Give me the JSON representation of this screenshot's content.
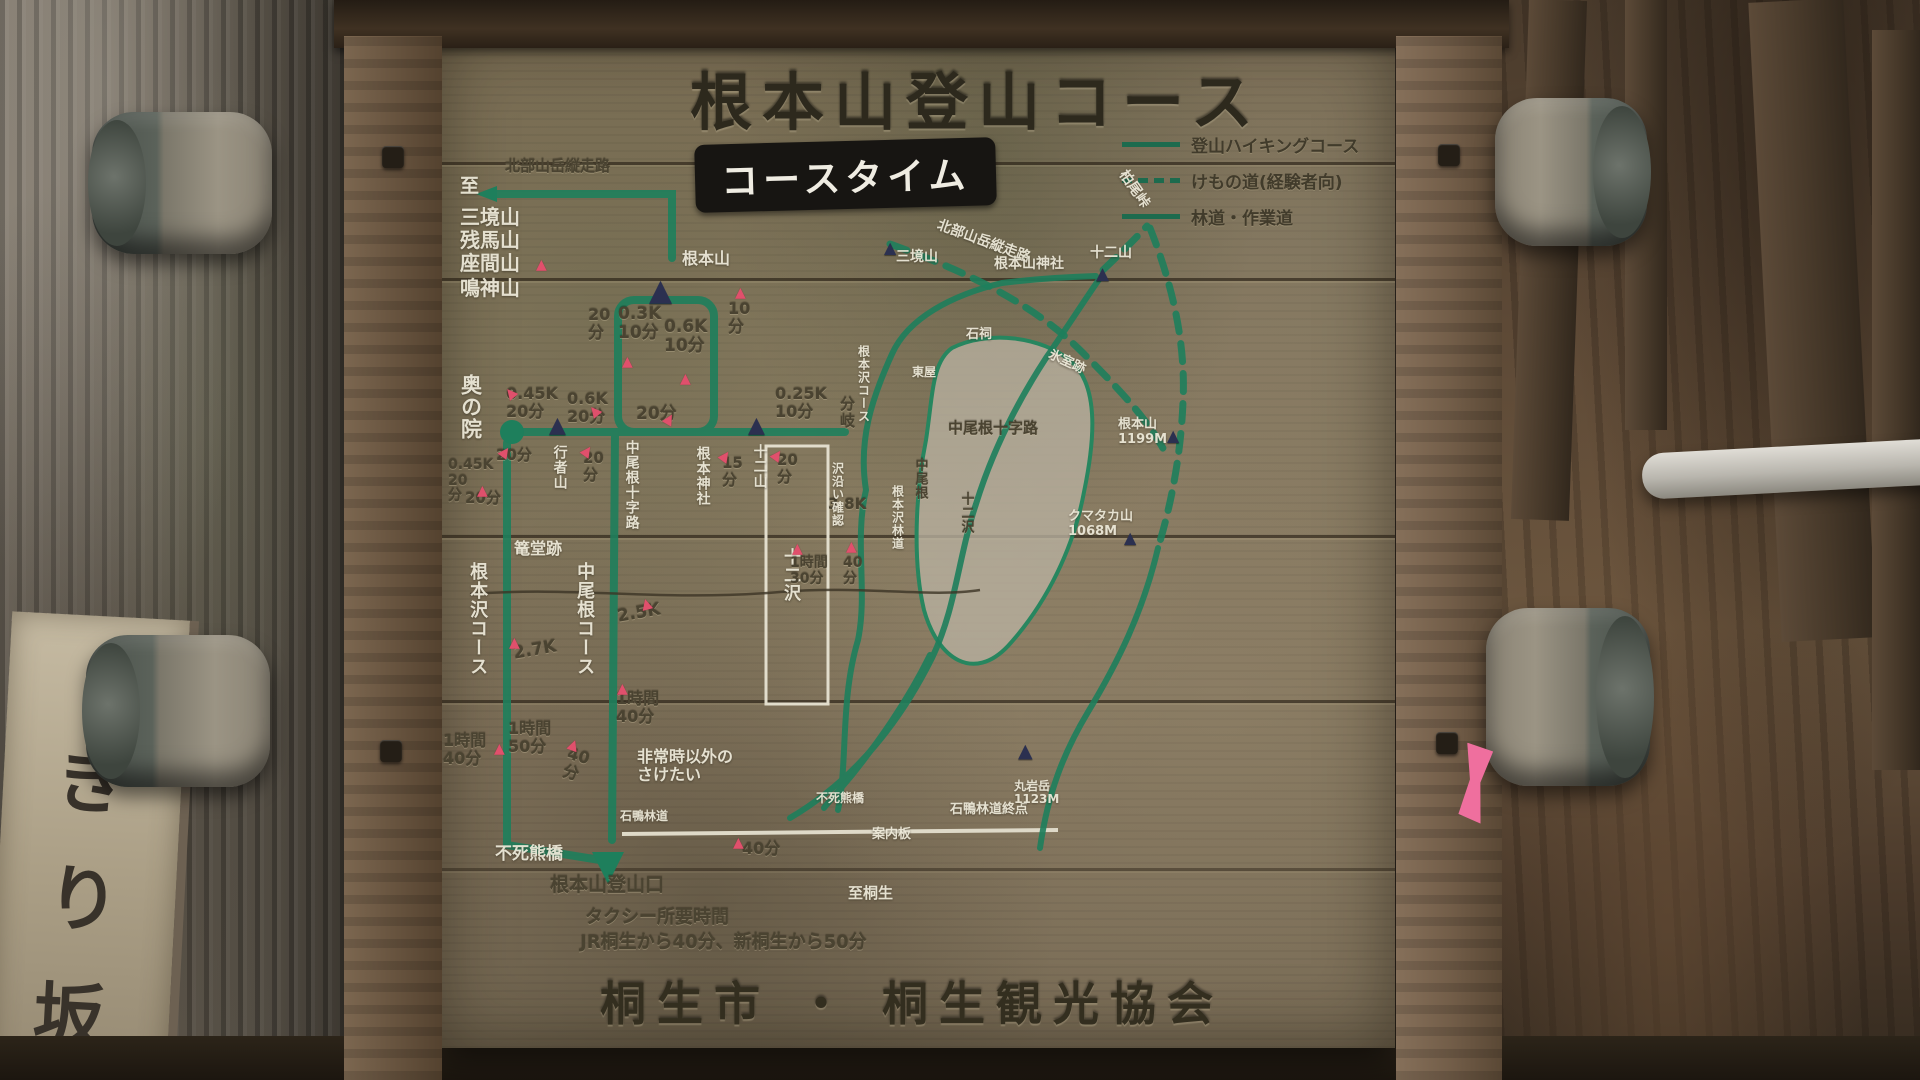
{
  "sign": {
    "title": "根本山登山コース",
    "course_time_heading": "コースタイム",
    "credit": "桐生市 ・ 桐生観光協会",
    "legend": {
      "items": [
        {
          "line": "solid",
          "label": "登山ハイキングコース"
        },
        {
          "line": "dashed",
          "label": "けもの道(経験者向)"
        },
        {
          "line": "solid",
          "label": "林道・作業道"
        }
      ]
    }
  },
  "course_chart": {
    "labels": [
      {
        "t": "至",
        "x": 460,
        "y": 176,
        "fs": 19,
        "c": "w"
      },
      {
        "t": "三境山",
        "x": 460,
        "y": 206,
        "fs": 20,
        "c": "w"
      },
      {
        "t": "残馬山",
        "x": 460,
        "y": 229,
        "fs": 20,
        "c": "w"
      },
      {
        "t": "座間山",
        "x": 460,
        "y": 252,
        "fs": 20,
        "c": "w"
      },
      {
        "t": "鳴神山",
        "x": 460,
        "y": 277,
        "fs": 20,
        "c": "w"
      },
      {
        "t": "北部山岳縦走路",
        "x": 505,
        "y": 158,
        "fs": 15,
        "c": "d"
      },
      {
        "t": "根本山",
        "x": 682,
        "y": 250,
        "fs": 16,
        "c": "w"
      },
      {
        "t": "20\n分",
        "x": 588,
        "y": 306,
        "fs": 16,
        "c": "d"
      },
      {
        "t": "0.3K\n10分",
        "x": 618,
        "y": 305,
        "fs": 17,
        "c": "d"
      },
      {
        "t": "0.6K\n 10分",
        "x": 664,
        "y": 318,
        "fs": 17,
        "c": "d"
      },
      {
        "t": "10\n分",
        "x": 728,
        "y": 300,
        "fs": 16,
        "c": "d"
      },
      {
        "t": "20分",
        "x": 636,
        "y": 405,
        "fs": 17,
        "c": "d"
      },
      {
        "t": "0.45K\n 20分",
        "x": 506,
        "y": 385,
        "fs": 16,
        "c": "d"
      },
      {
        "t": "0.6K\n20分",
        "x": 567,
        "y": 390,
        "fs": 16,
        "c": "d"
      },
      {
        "t": "0.25K\n 10分",
        "x": 775,
        "y": 385,
        "fs": 16,
        "c": "d"
      },
      {
        "t": "分\n岐",
        "x": 840,
        "y": 396,
        "fs": 15,
        "c": "d"
      },
      {
        "t": "奥の院",
        "x": 458,
        "y": 374,
        "fs": 21,
        "c": "w",
        "v": 1
      },
      {
        "t": "0.45K\n20\n分",
        "x": 448,
        "y": 458,
        "fs": 14,
        "c": "d"
      },
      {
        "t": "20分",
        "x": 496,
        "y": 447,
        "fs": 15,
        "c": "d"
      },
      {
        "t": "20\n分",
        "x": 583,
        "y": 450,
        "fs": 15,
        "c": "d"
      },
      {
        "t": "20分",
        "x": 465,
        "y": 490,
        "fs": 15,
        "c": "d"
      },
      {
        "t": "行者山",
        "x": 551,
        "y": 445,
        "fs": 14,
        "c": "w",
        "v": 1
      },
      {
        "t": "中尾根十字路",
        "x": 623,
        "y": 440,
        "fs": 14,
        "c": "w",
        "v": 1
      },
      {
        "t": "根本神社",
        "x": 694,
        "y": 446,
        "fs": 14,
        "c": "w",
        "v": 1
      },
      {
        "t": "15\n分",
        "x": 722,
        "y": 455,
        "fs": 15,
        "c": "d"
      },
      {
        "t": "十二山",
        "x": 751,
        "y": 444,
        "fs": 14,
        "c": "w",
        "v": 1
      },
      {
        "t": "20\n分",
        "x": 777,
        "y": 452,
        "fs": 15,
        "c": "d"
      },
      {
        "t": "篭堂跡",
        "x": 514,
        "y": 540,
        "fs": 16,
        "c": "w"
      },
      {
        "t": "根本沢コース",
        "x": 467,
        "y": 562,
        "fs": 18,
        "c": "w",
        "v": 1
      },
      {
        "t": "中尾根コース",
        "x": 574,
        "y": 562,
        "fs": 18,
        "c": "w",
        "v": 1
      },
      {
        "t": "2.7K",
        "x": 512,
        "y": 645,
        "fs": 17,
        "c": "d",
        "r": -10
      },
      {
        "t": "2.5K",
        "x": 616,
        "y": 608,
        "fs": 17,
        "c": "d",
        "r": -10
      },
      {
        "t": "十二沢",
        "x": 780,
        "y": 548,
        "fs": 17,
        "c": "w",
        "v": 1
      },
      {
        "t": "3.8K",
        "x": 828,
        "y": 496,
        "fs": 15,
        "c": "d"
      },
      {
        "t": "1時間\n30分",
        "x": 790,
        "y": 556,
        "fs": 14,
        "c": "d"
      },
      {
        "t": "40\n分",
        "x": 843,
        "y": 556,
        "fs": 14,
        "c": "d"
      },
      {
        "t": "1時間\n40分",
        "x": 443,
        "y": 732,
        "fs": 16,
        "c": "d"
      },
      {
        "t": "1時間\n50分",
        "x": 508,
        "y": 720,
        "fs": 16,
        "c": "d"
      },
      {
        "t": "40\n分",
        "x": 570,
        "y": 745,
        "fs": 16,
        "c": "d",
        "r": 15
      },
      {
        "t": "1時間\n40分",
        "x": 616,
        "y": 690,
        "fs": 16,
        "c": "d"
      },
      {
        "t": "非常時以外の\n さけたい",
        "x": 637,
        "y": 748,
        "fs": 16,
        "c": "w"
      },
      {
        "t": "石鴨林道",
        "x": 620,
        "y": 810,
        "fs": 12,
        "c": "w"
      },
      {
        "t": "不死熊橋",
        "x": 495,
        "y": 845,
        "fs": 17,
        "c": "w"
      },
      {
        "t": "40分",
        "x": 742,
        "y": 840,
        "fs": 16,
        "c": "d"
      },
      {
        "t": "根本山登山口",
        "x": 550,
        "y": 875,
        "fs": 19,
        "c": "d"
      },
      {
        "t": "タクシー所要時間",
        "x": 585,
        "y": 908,
        "fs": 18,
        "c": "d"
      },
      {
        "t": "JR桐生から40分、新桐生から50分",
        "x": 580,
        "y": 933,
        "fs": 18,
        "c": "d"
      }
    ]
  },
  "map": {
    "labels": [
      {
        "t": "三境山",
        "x": 896,
        "y": 250,
        "fs": 14,
        "c": "w"
      },
      {
        "t": "北部山岳縦走路",
        "x": 940,
        "y": 218,
        "fs": 14,
        "c": "w",
        "r": 20
      },
      {
        "t": "柏尾峠",
        "x": 1128,
        "y": 168,
        "fs": 14,
        "c": "w",
        "r": 55
      },
      {
        "t": "根本山神社",
        "x": 994,
        "y": 257,
        "fs": 14,
        "c": "w"
      },
      {
        "t": "十二山",
        "x": 1090,
        "y": 246,
        "fs": 14,
        "c": "w"
      },
      {
        "t": "石祠",
        "x": 966,
        "y": 328,
        "fs": 13,
        "c": "w"
      },
      {
        "t": "氷室跡",
        "x": 1052,
        "y": 348,
        "fs": 13,
        "c": "w",
        "r": 25
      },
      {
        "t": "東屋",
        "x": 912,
        "y": 366,
        "fs": 12,
        "c": "w"
      },
      {
        "t": "根本沢コース",
        "x": 856,
        "y": 345,
        "fs": 12,
        "c": "w",
        "v": 1
      },
      {
        "t": "根本山\n1199M",
        "x": 1118,
        "y": 418,
        "fs": 13,
        "c": "w"
      },
      {
        "t": "中尾根十字路",
        "x": 948,
        "y": 420,
        "fs": 15,
        "c": "d"
      },
      {
        "t": "中尾根",
        "x": 912,
        "y": 458,
        "fs": 13,
        "c": "d",
        "v": 1
      },
      {
        "t": "沢沿い確認",
        "x": 830,
        "y": 462,
        "fs": 12,
        "c": "w",
        "v": 1
      },
      {
        "t": "根本沢林道",
        "x": 890,
        "y": 485,
        "fs": 12,
        "c": "w",
        "v": 1
      },
      {
        "t": "十二沢",
        "x": 958,
        "y": 492,
        "fs": 13,
        "c": "d",
        "v": 1
      },
      {
        "t": "クマタカ山\n1068M",
        "x": 1068,
        "y": 510,
        "fs": 13,
        "c": "w"
      },
      {
        "t": "不死熊橋",
        "x": 816,
        "y": 792,
        "fs": 12,
        "c": "w"
      },
      {
        "t": "案内板",
        "x": 872,
        "y": 828,
        "fs": 13,
        "c": "w"
      },
      {
        "t": "石鴨林道終点",
        "x": 950,
        "y": 803,
        "fs": 13,
        "c": "w"
      },
      {
        "t": "至桐生",
        "x": 848,
        "y": 885,
        "fs": 15,
        "c": "w"
      },
      {
        "t": "丸岩岳\n1123M",
        "x": 1014,
        "y": 780,
        "fs": 12,
        "c": "w"
      }
    ]
  },
  "markers": {
    "peaks": [
      {
        "x": 649,
        "y": 276,
        "s": 30
      },
      {
        "x": 549,
        "y": 415,
        "s": 22
      },
      {
        "x": 748,
        "y": 415,
        "s": 22
      },
      {
        "x": 884,
        "y": 240,
        "s": 16
      },
      {
        "x": 1096,
        "y": 266,
        "s": 17
      },
      {
        "x": 1167,
        "y": 428,
        "s": 16
      },
      {
        "x": 1124,
        "y": 530,
        "s": 16
      },
      {
        "x": 1018,
        "y": 742,
        "s": 19
      }
    ],
    "arrows": [
      {
        "x": 536,
        "y": 258
      },
      {
        "x": 622,
        "y": 355
      },
      {
        "x": 680,
        "y": 372
      },
      {
        "x": 735,
        "y": 286
      },
      {
        "x": 505,
        "y": 386,
        "r": -40
      },
      {
        "x": 589,
        "y": 404,
        "r": -40
      },
      {
        "x": 664,
        "y": 412,
        "r": 30
      },
      {
        "x": 500,
        "y": 445,
        "r": 35
      },
      {
        "x": 582,
        "y": 444,
        "r": 35
      },
      {
        "x": 477,
        "y": 484
      },
      {
        "x": 720,
        "y": 449,
        "r": 35
      },
      {
        "x": 772,
        "y": 448,
        "r": 35
      },
      {
        "x": 846,
        "y": 540
      },
      {
        "x": 792,
        "y": 542
      },
      {
        "x": 494,
        "y": 742
      },
      {
        "x": 617,
        "y": 682
      },
      {
        "x": 733,
        "y": 836
      },
      {
        "x": 568,
        "y": 738,
        "r": 20
      },
      {
        "x": 509,
        "y": 636
      },
      {
        "x": 641,
        "y": 597,
        "r": -15
      }
    ]
  },
  "side_sign": {
    "chars": [
      "き",
      "り",
      "坂"
    ]
  }
}
